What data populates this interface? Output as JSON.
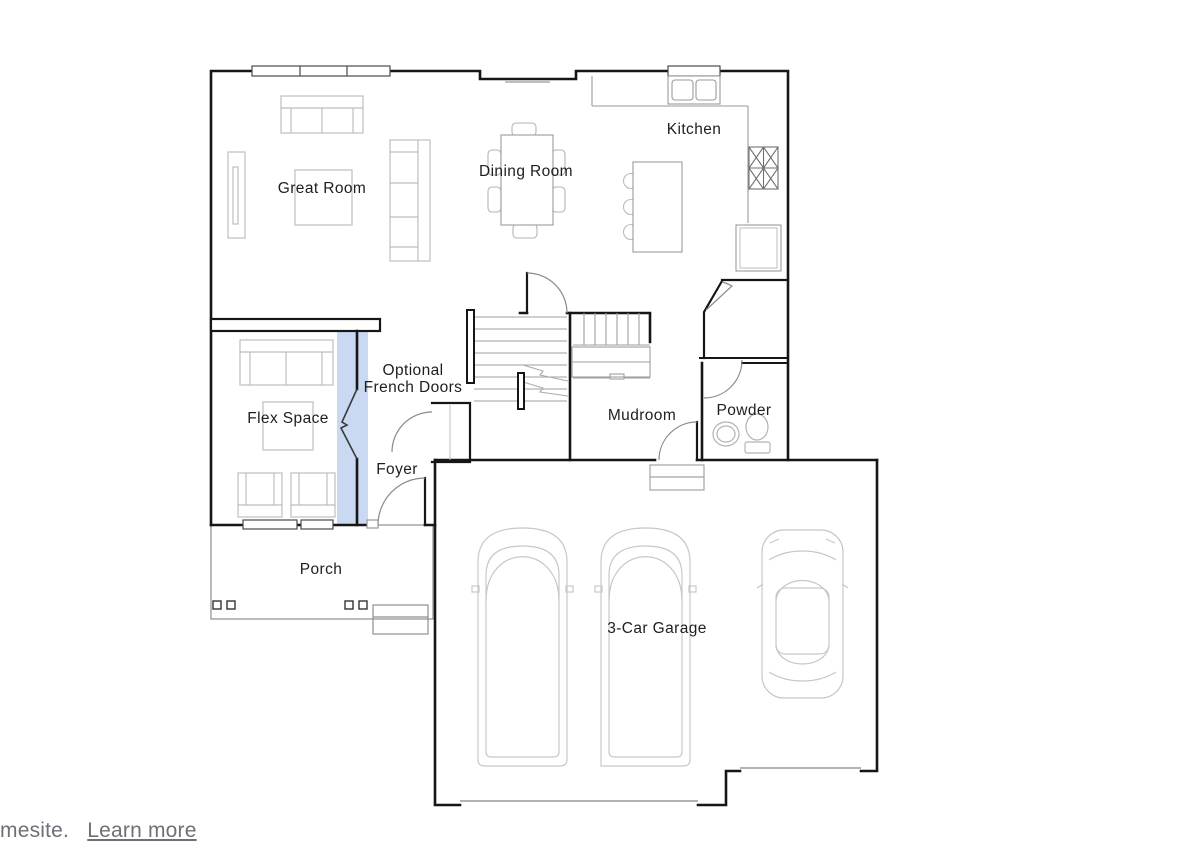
{
  "floor_plan": {
    "rooms": [
      {
        "id": "great-room",
        "label": "Great Room"
      },
      {
        "id": "dining-room",
        "label": "Dining Room"
      },
      {
        "id": "kitchen",
        "label": "Kitchen"
      },
      {
        "id": "flex-space",
        "label": "Flex Space"
      },
      {
        "id": "mudroom",
        "label": "Mudroom"
      },
      {
        "id": "powder",
        "label": "Powder"
      },
      {
        "id": "foyer",
        "label": "Foyer"
      },
      {
        "id": "porch",
        "label": "Porch"
      },
      {
        "id": "garage",
        "label": "3-Car Garage"
      }
    ],
    "annotations": [
      {
        "id": "optional-french-doors",
        "line1": "Optional",
        "line2": "French Doors"
      }
    ],
    "colors": {
      "wall": "#161616",
      "fixture": "#9a9a9a",
      "furniture": "#bdbdbd",
      "door": "#8a8a8a",
      "optional_highlight": "#c9d9f2"
    }
  },
  "footer": {
    "prefix": "mesite.",
    "link_label": "Learn more"
  }
}
